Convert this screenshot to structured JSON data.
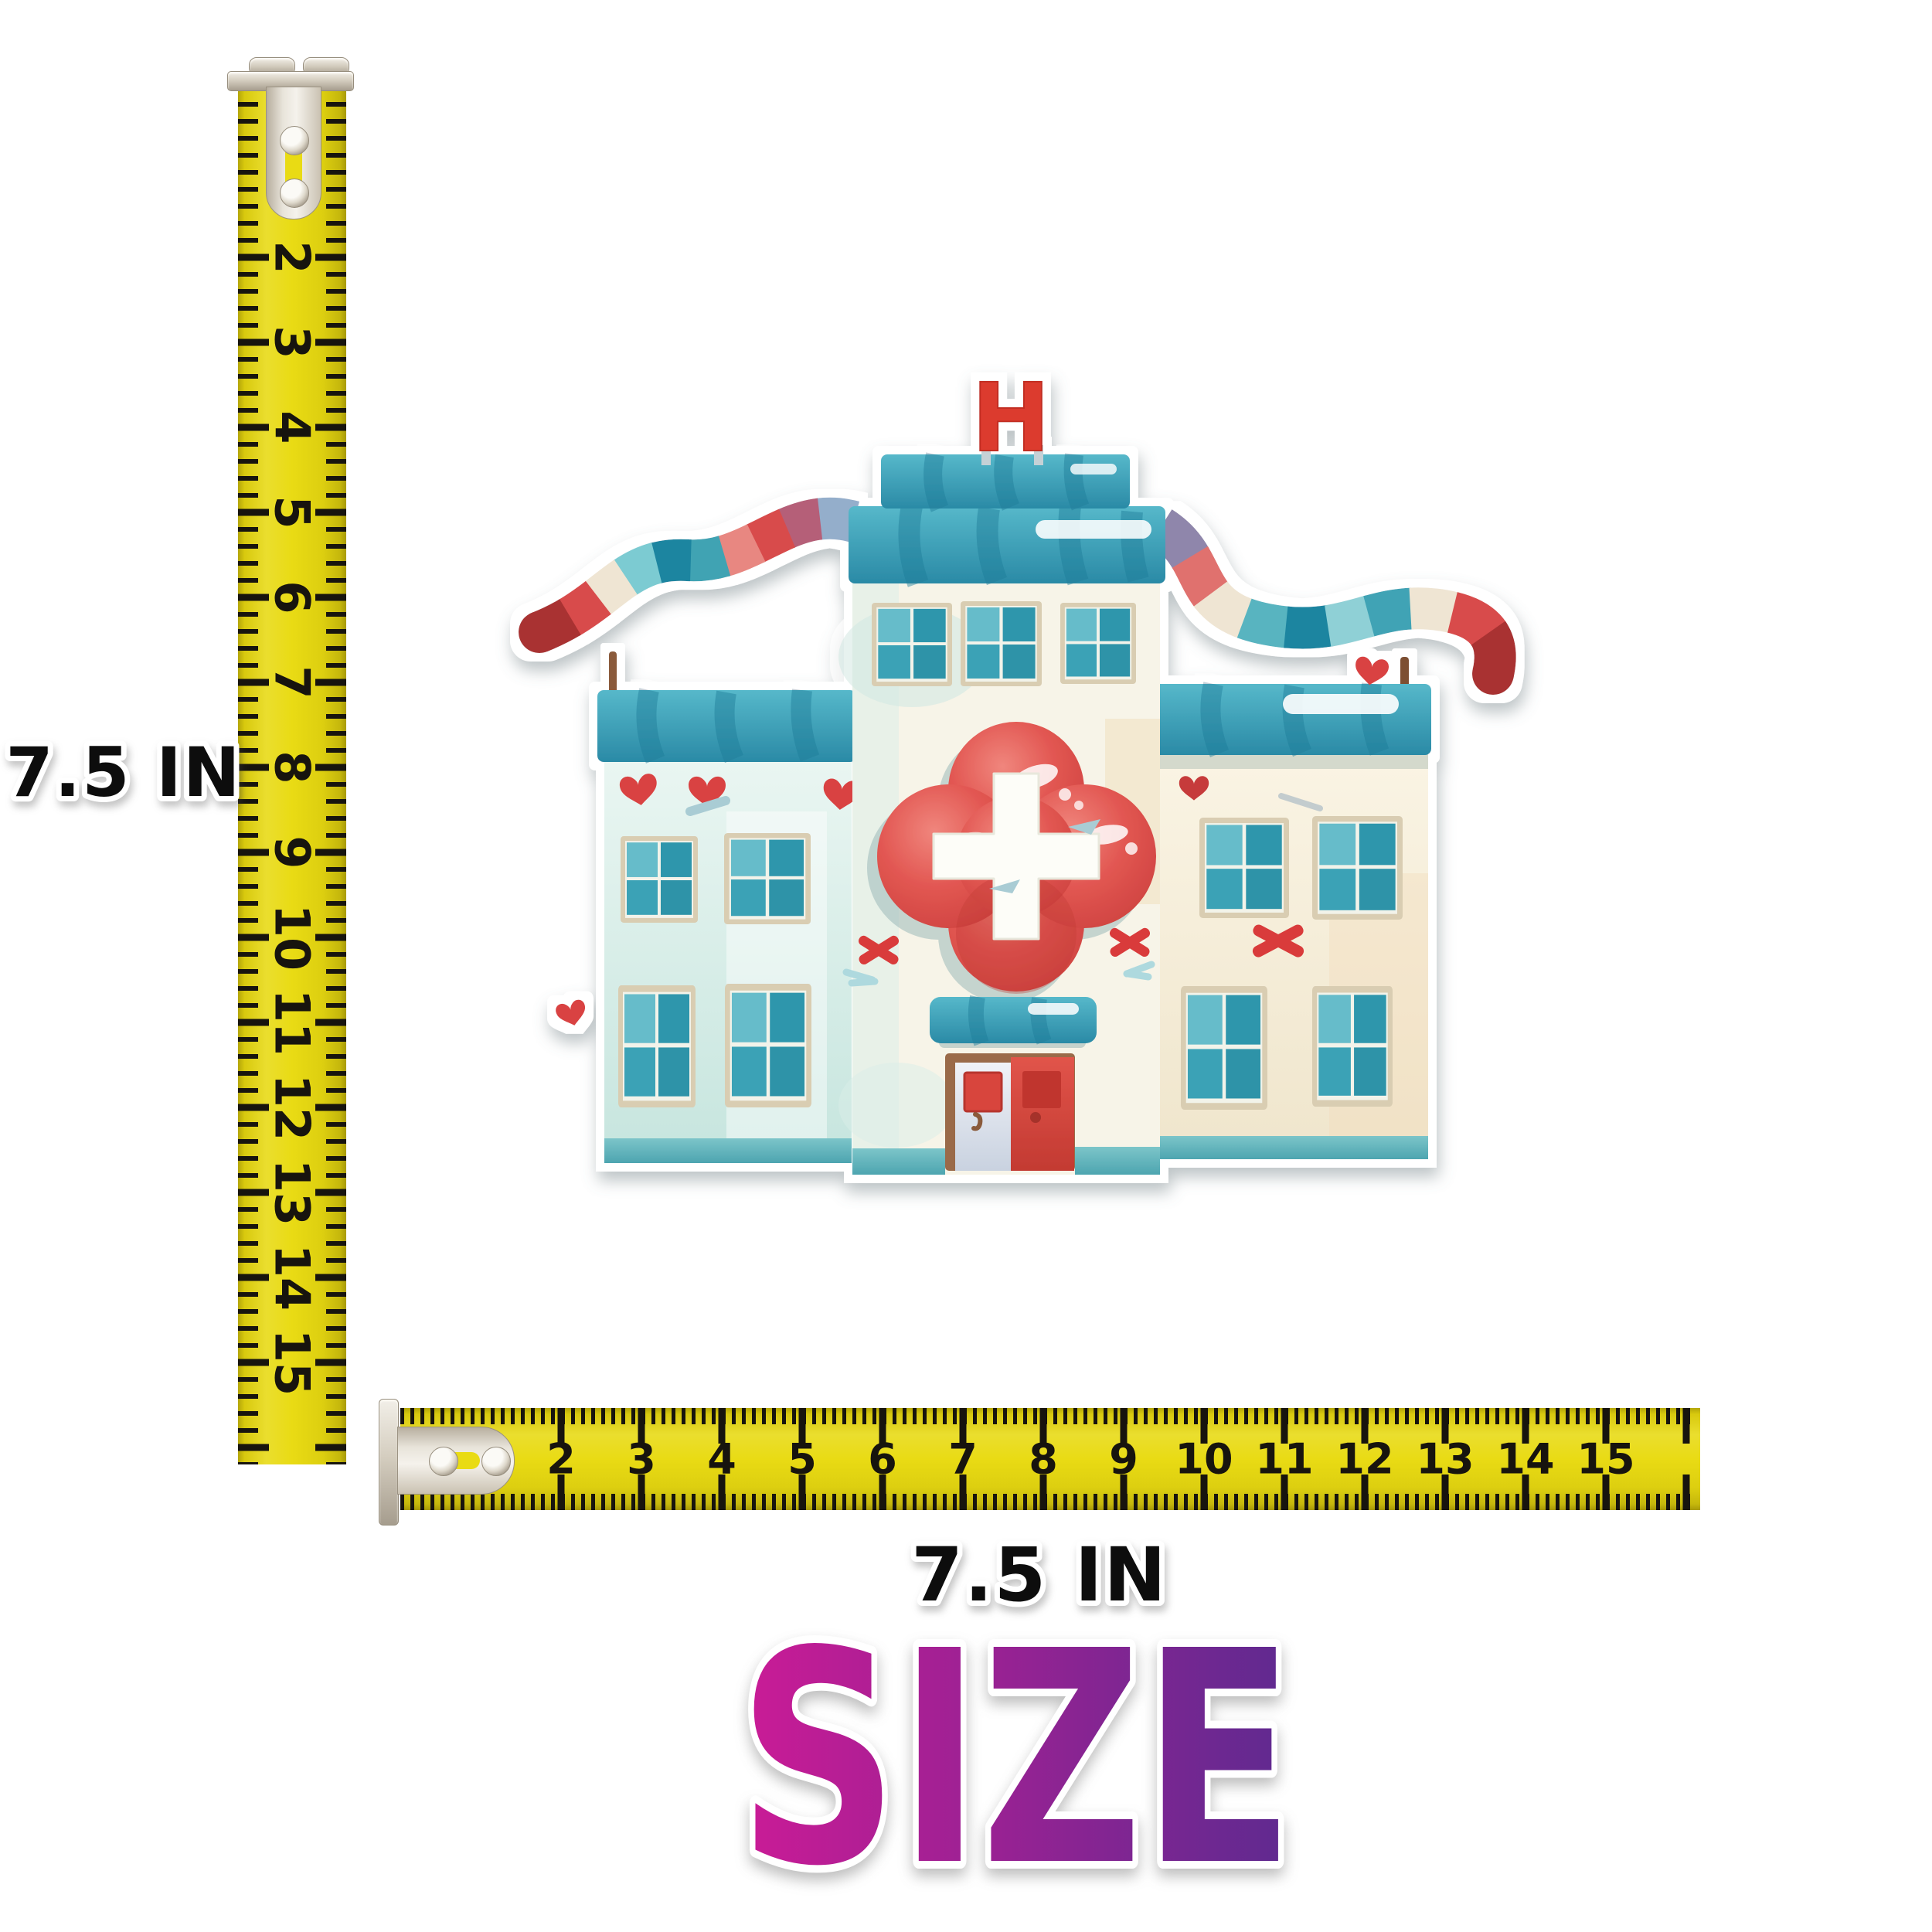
{
  "page": {
    "background_color": "#ffffff"
  },
  "rulers": {
    "tape_color": "#e9db14",
    "tick_color": "#17140e",
    "clip_color": "#d5cec0",
    "vertical": {
      "numbers": [
        "2",
        "3",
        "4",
        "5",
        "6",
        "7",
        "8",
        "9",
        "10",
        "11",
        "12",
        "13",
        "14",
        "15"
      ]
    },
    "horizontal": {
      "numbers": [
        "2",
        "3",
        "4",
        "5",
        "6",
        "7",
        "8",
        "9",
        "10",
        "11",
        "12",
        "13",
        "14",
        "15"
      ]
    }
  },
  "labels": {
    "height": "7.5 IN",
    "width": "7.5 IN"
  },
  "size_title": {
    "text": "SIZE",
    "gradient_start": "#cb1b96",
    "gradient_end": "#5e2a90",
    "outline_color": "#ffffff"
  },
  "sticker": {
    "type": "watercolor hospital building sticker",
    "sign_letter": "H",
    "palette": {
      "roof_teal": "#2f93ab",
      "wall_mint": "#d9ece6",
      "wall_cream": "#f6efdc",
      "heart_red": "#d94343",
      "emblem_red": "#e25752",
      "cross_white": "#fdfdf8",
      "door_red": "#d84a40",
      "door_white": "#eef0f6",
      "frame_brown": "#9a6b4a",
      "banner_teal": "#3fa3b5",
      "banner_red": "#d84c4c",
      "pole_brown": "#8a5a3b",
      "window_teal": "#3aa2b6",
      "window_frame_tan": "#d9cdb2",
      "sticker_outline": "#ffffff"
    }
  }
}
